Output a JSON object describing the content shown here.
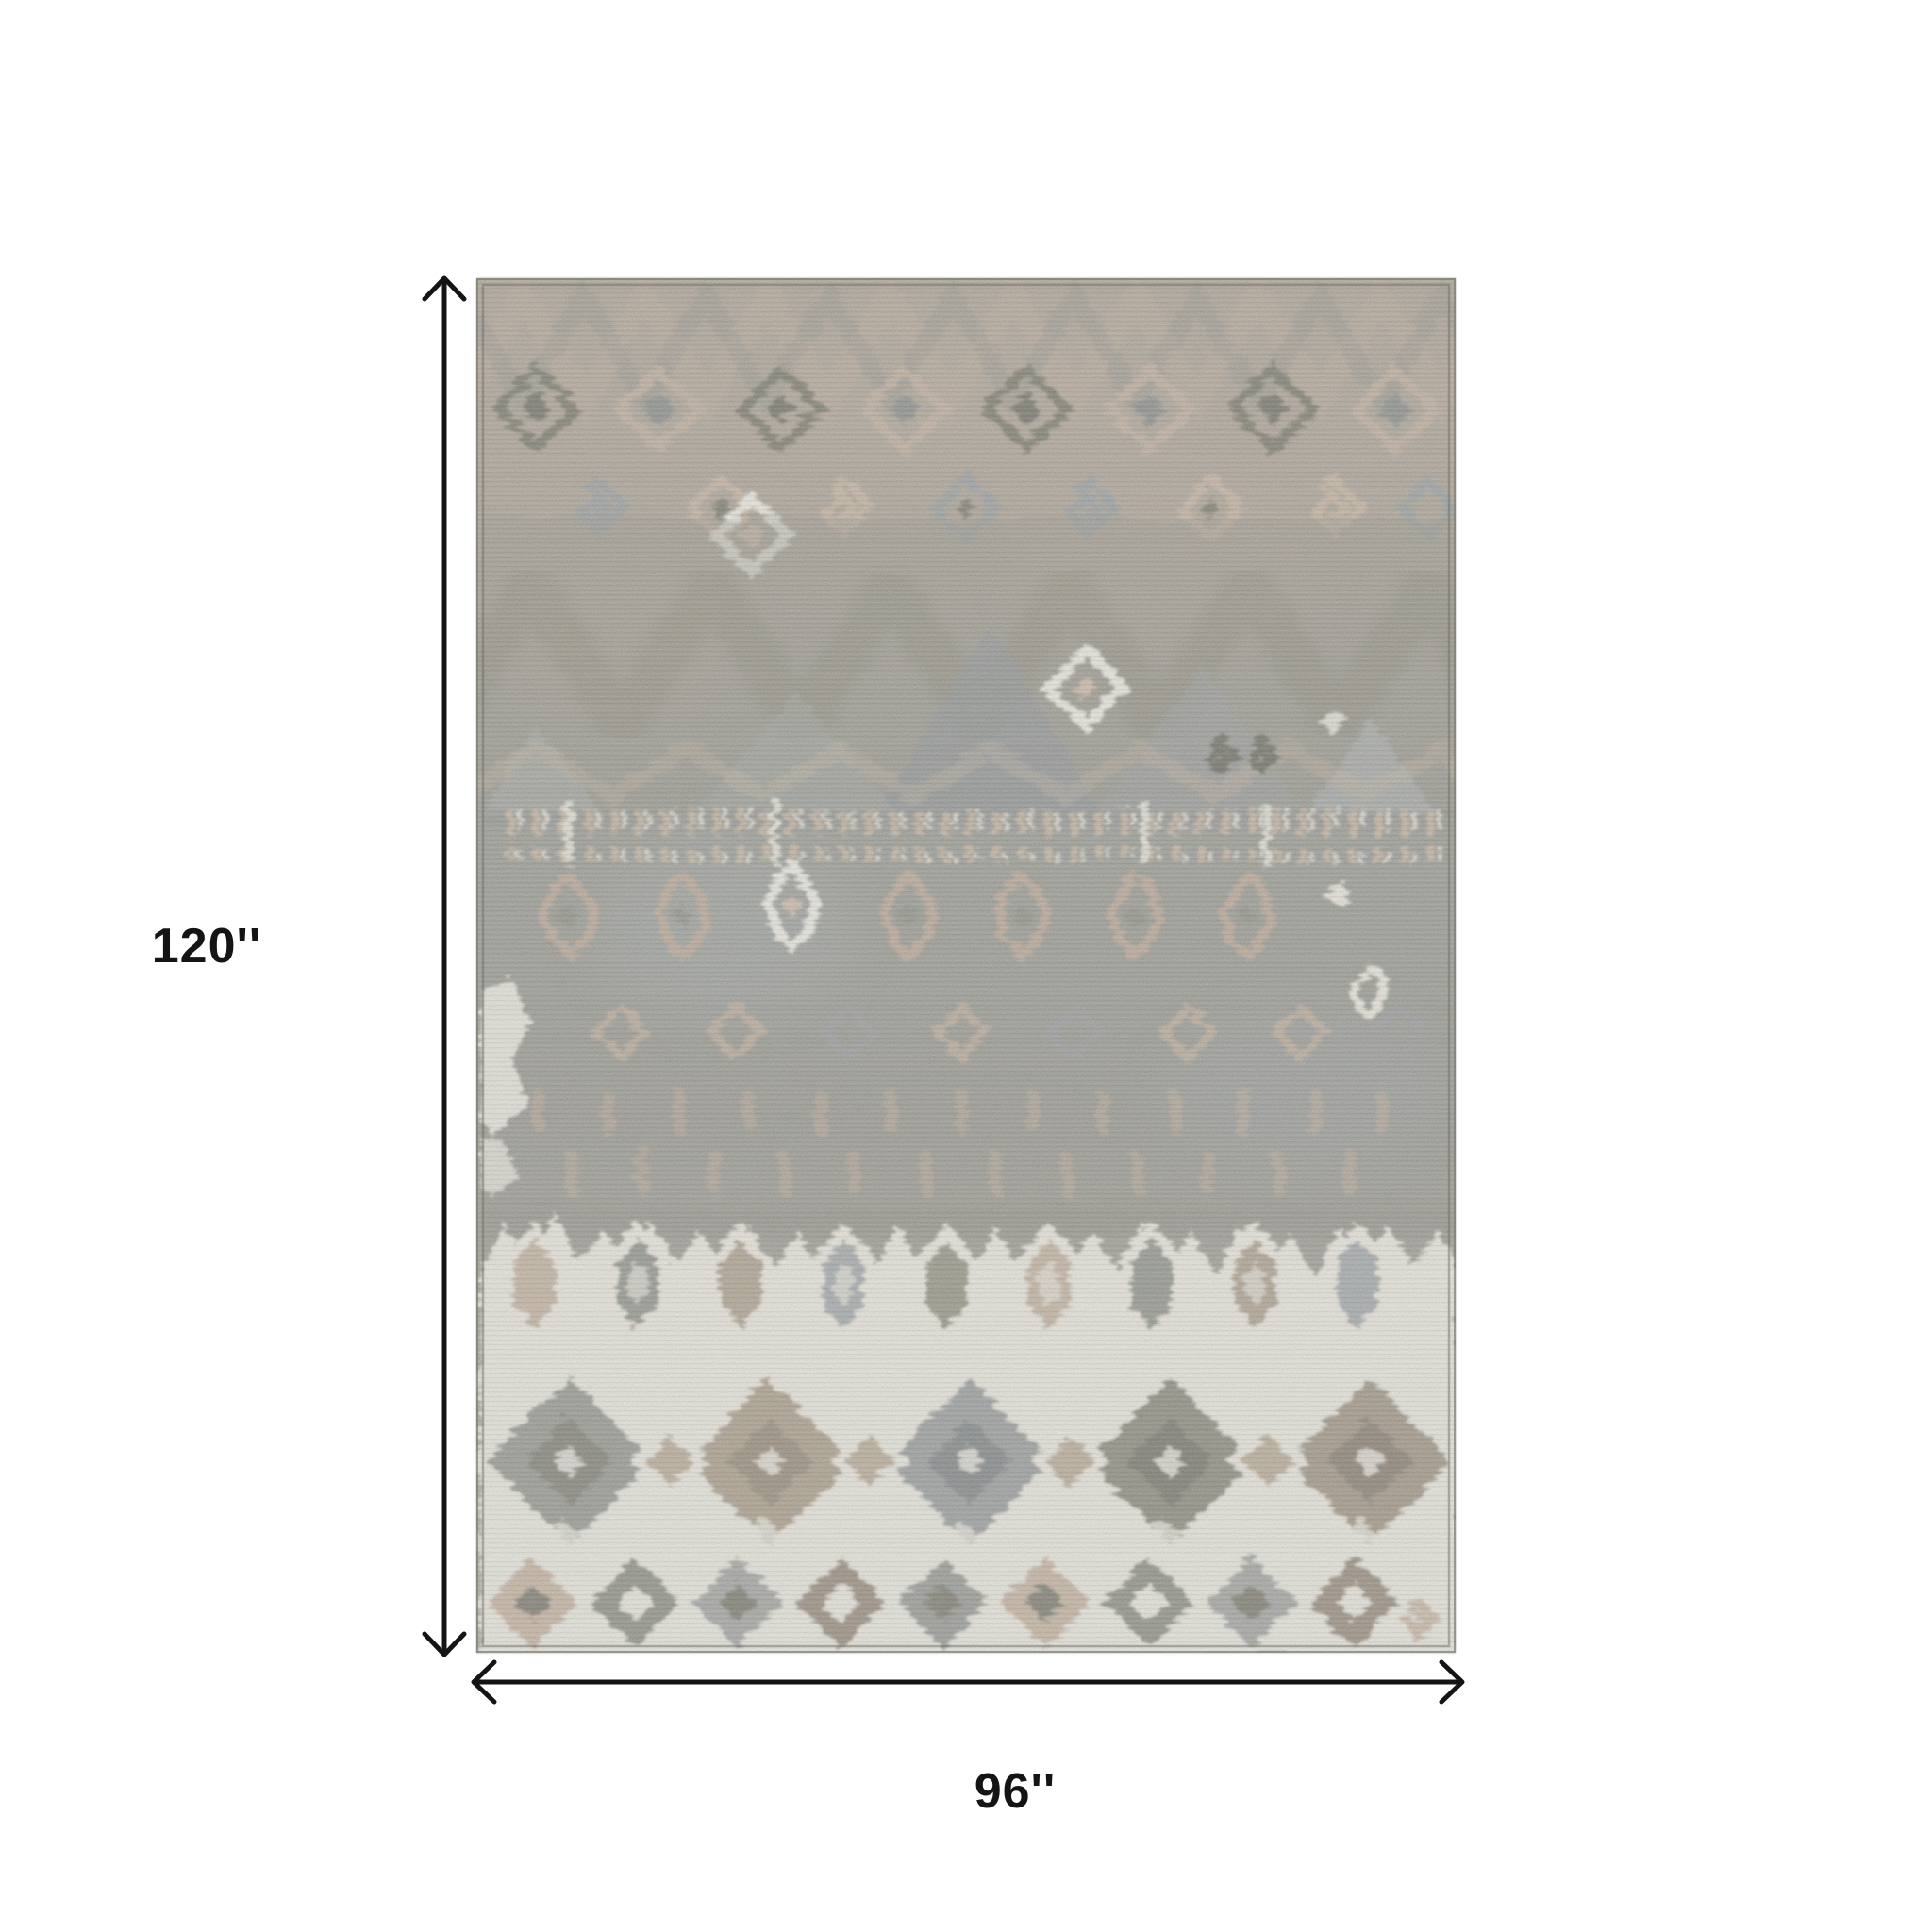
{
  "page": {
    "background_color": "#ffffff"
  },
  "annotation": {
    "height_label": "120''",
    "width_label": "96''",
    "arrow_color": "#141414",
    "label_color": "#141414"
  },
  "rug": {
    "palette": {
      "taupe": "#a29a8c",
      "blush_tan": "#bfab97",
      "olive": "#6d6c5e",
      "gray": "#8c8d89",
      "slate": "#9aa0a2",
      "cream": "#e6e3d9"
    }
  }
}
